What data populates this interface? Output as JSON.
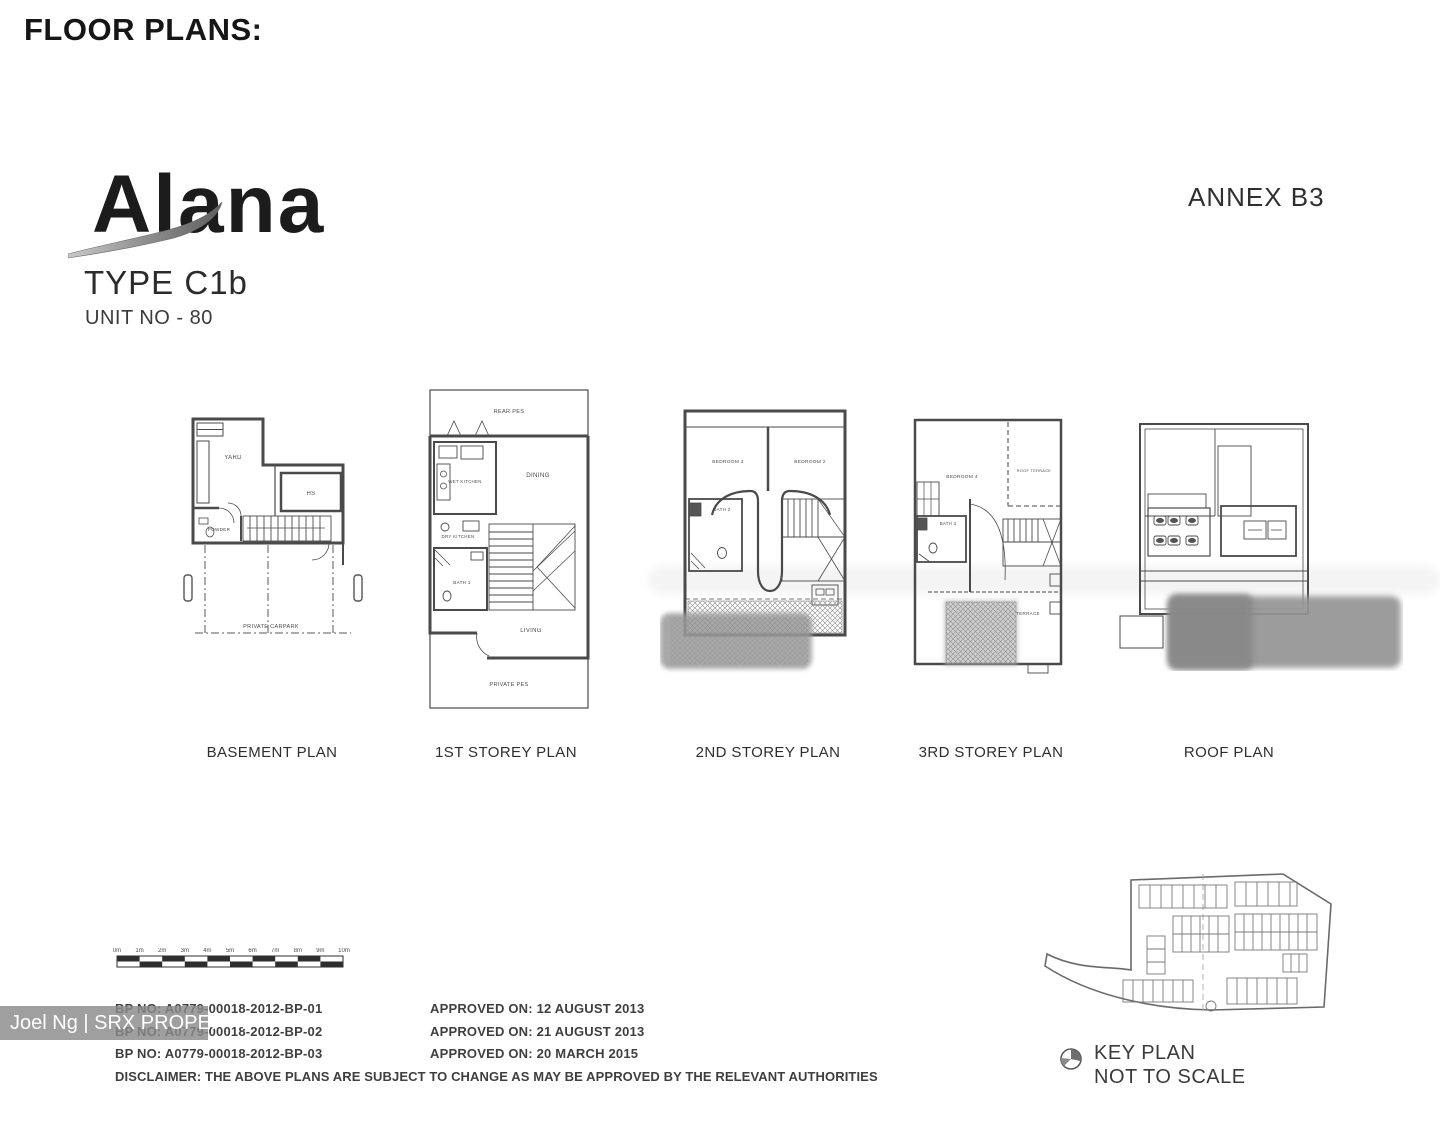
{
  "header": {
    "title": "FLOOR PLANS:",
    "annex": "ANNEX B3"
  },
  "logo": {
    "brand": "Alana",
    "type": "TYPE C1b",
    "unit": "UNIT NO  - 80"
  },
  "plans": {
    "basement": {
      "caption": "BASEMENT PLAN",
      "yard": "YARD",
      "hs": "HS",
      "powder": "POWDER",
      "carpark": "PRIVATE CARPARK"
    },
    "storey1": {
      "caption": "1ST STOREY PLAN",
      "rear_pes": "REAR PES",
      "wet_kitchen": "WET KITCHEN",
      "dry_kitchen": "DRY KITCHEN",
      "bath1": "BATH 1",
      "dining": "DINING",
      "living": "LIVING",
      "private_pes": "PRIVATE PES"
    },
    "storey2": {
      "caption": "2ND STOREY PLAN",
      "bedroom3": "BEDROOM 3",
      "bedroom2": "BEDROOM 2",
      "bath2": "BATH 2"
    },
    "storey3": {
      "caption": "3RD STOREY PLAN",
      "bedroom4": "BEDROOM 4",
      "roof_terrace": "ROOF TERRACE",
      "bath3": "BATH 3",
      "terrace": "TERRACE"
    },
    "roof": {
      "caption": "ROOF PLAN"
    }
  },
  "scale_bar": {
    "labels": [
      "0m",
      "1m",
      "2m",
      "3m",
      "4m",
      "5m",
      "6m",
      "7m",
      "8m",
      "9m",
      "10m"
    ]
  },
  "approvals": [
    {
      "bp": "BP NO: A0779-00018-2012-BP-01",
      "date": "APPROVED ON: 12 AUGUST 2013"
    },
    {
      "bp": "BP NO: A0779-00018-2012-BP-02",
      "date": "APPROVED ON: 21 AUGUST 2013"
    },
    {
      "bp": "BP NO: A0779-00018-2012-BP-03",
      "date": "APPROVED ON: 20 MARCH 2015"
    }
  ],
  "disclaimer": "DISCLAIMER: THE ABOVE PLANS ARE SUBJECT TO CHANGE AS MAY BE APPROVED BY THE RELEVANT AUTHORITIES",
  "key_plan": {
    "label": "KEY PLAN",
    "note": "NOT TO SCALE"
  },
  "watermark": "Joel Ng | SRX PROPERTY",
  "colors": {
    "ink": "#3f3f3f",
    "wall": "#4a4a4a",
    "blur_gray": "#979797",
    "watermark_bg": "#8a8a8a"
  }
}
